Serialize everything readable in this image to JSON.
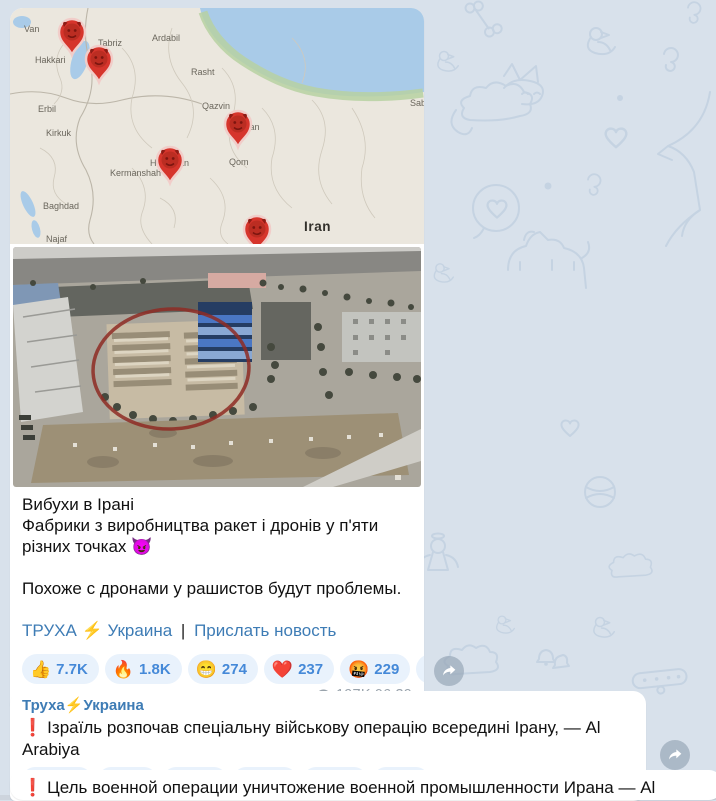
{
  "app": "telegram-channel-feed",
  "colors": {
    "background": "#d8e1eb",
    "doodle": "#c5d3e2",
    "bubble": "#ffffff",
    "link_blue": "#3e7cb5",
    "reaction_bg": "#e9f2fc",
    "reaction_text": "#4589d8",
    "meta_gray": "#99a3ac",
    "alert_red": "#df3b40",
    "pin_red": "#d6352c",
    "map_water": "#a9cbe8",
    "map_land": "#ebe7de"
  },
  "map": {
    "country": "Iran",
    "pin_icon": "devil-pin-marker",
    "pin_count": 5,
    "labels": [
      {
        "text": "Van"
      },
      {
        "text": "Hakkari"
      },
      {
        "text": "Tabriz"
      },
      {
        "text": "Ardabil"
      },
      {
        "text": "Rasht"
      },
      {
        "text": "Erbil"
      },
      {
        "text": "Qazvin"
      },
      {
        "text": "Sabze"
      },
      {
        "text": "Kirkuk"
      },
      {
        "text": "Tehran"
      },
      {
        "text": "Hamadan"
      },
      {
        "text": "Kermanshah"
      },
      {
        "text": "Qom"
      },
      {
        "text": "Baghdad"
      },
      {
        "text": "Najaf"
      },
      {
        "text": "Iran"
      }
    ]
  },
  "messages": [
    {
      "texts": {
        "line1": "Вибухи в Ірані",
        "line2": "Фабрики з виробництва ракет і дронів у п'яти різних точках 😈",
        "para": "Похоже с дронами у рашистов будут проблемы."
      },
      "links": {
        "channel": "ТРУХА ⚡ Украина",
        "sep": "|",
        "submit": "Прислать новость"
      },
      "reactions": [
        {
          "emoji": "👍",
          "count": "7.7K"
        },
        {
          "emoji": "🔥",
          "count": "1.8K"
        },
        {
          "emoji": "😁",
          "count": "274"
        },
        {
          "emoji": "❤️",
          "count": "237"
        },
        {
          "emoji": "🤬",
          "count": "229"
        },
        {
          "emoji": "😢",
          "count": "28"
        }
      ],
      "meta": {
        "views": "197K",
        "time": "06:39"
      }
    },
    {
      "sender": "Труха⚡Украина",
      "alert": "❗",
      "text": "Ізраїль розпочав спеціальну військову операцію всередині Ірану, — Al Arabiya",
      "reactions": [
        {
          "emoji": "🔥",
          "count": "9.1K"
        },
        {
          "emoji": "👍",
          "count": "1K"
        },
        {
          "emoji": "🤬",
          "count": "408"
        },
        {
          "emoji": "😁",
          "count": "188"
        },
        {
          "emoji": "❤️",
          "count": "165"
        },
        {
          "emoji": "😢",
          "count": "75"
        }
      ],
      "meta": {
        "views": "192,6K",
        "time": "06:49"
      }
    },
    {
      "alert": "❗",
      "text": "Цель военной операции уничтожение военной промышленности Ирана — Al Arabiya."
    }
  ]
}
